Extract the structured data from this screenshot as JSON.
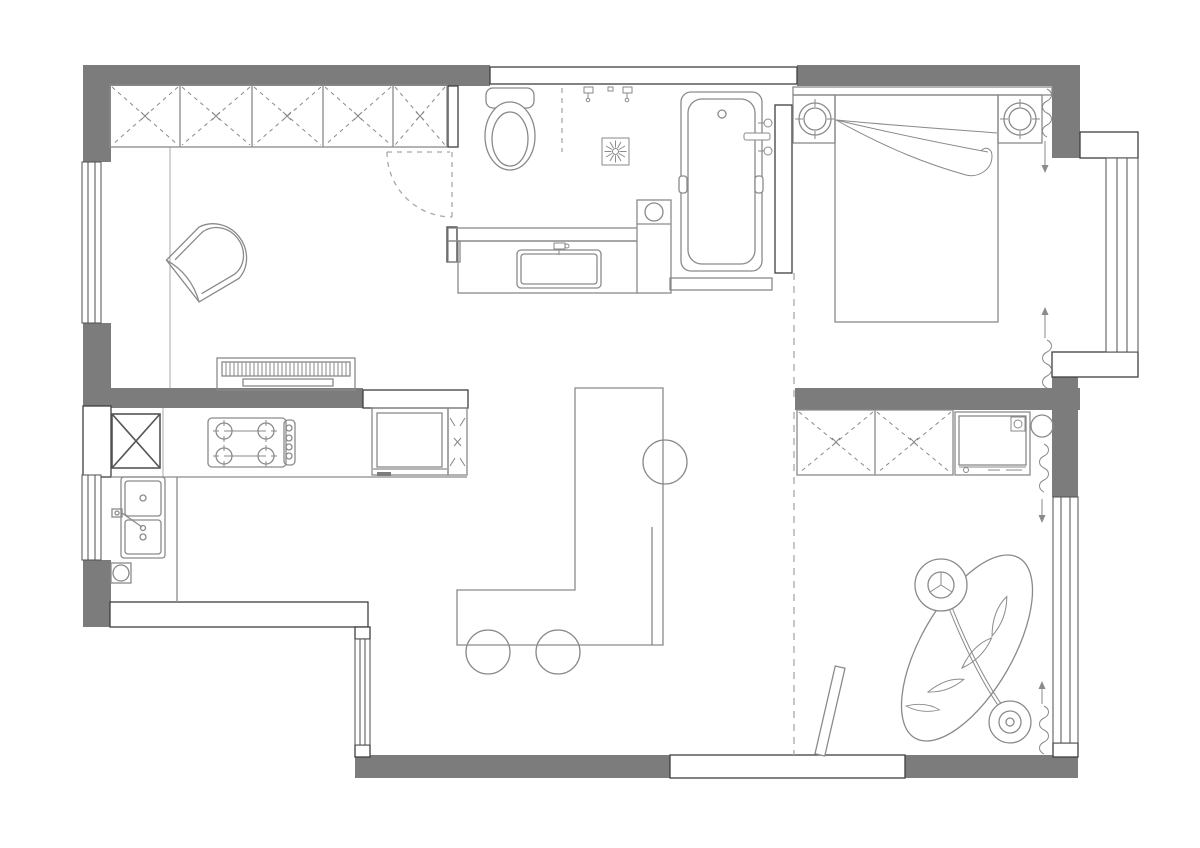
{
  "meta": {
    "kind": "architectural-floor-plan",
    "canvas_width": 1200,
    "canvas_height": 848,
    "text_labels_visible": false
  },
  "colors": {
    "background": "#ffffff",
    "wall_fill": "#7c7c7c",
    "wall_outline": "#3f3f3f",
    "window_line": "#4f4f4f",
    "furniture_line": "#8a8a8a",
    "light_line": "#aaaaaa",
    "dash_line": "#a8a8a8",
    "dark_accent": "#555555"
  },
  "rooms": [
    {
      "id": "living-room",
      "position": "top-left",
      "furniture": [
        "wardrobe",
        "armchair",
        "media-bench",
        "door-swing"
      ]
    },
    {
      "id": "kitchen",
      "position": "mid-left",
      "furniture": [
        "refrigerator",
        "gas-hob",
        "oven",
        "tall-cabinet",
        "double-sink",
        "sink-faucet",
        "floor-drain",
        "counter"
      ]
    },
    {
      "id": "dining-area",
      "position": "bottom-center",
      "furniture": [
        "l-shaped-bar-counter",
        "bar-stools"
      ]
    },
    {
      "id": "bathroom",
      "position": "top-center",
      "furniture": [
        "toilet",
        "shower-heads",
        "shower-floor-drain",
        "shower-glass-partition",
        "vanity-counter",
        "vanity-sink",
        "washer-column",
        "bathtub",
        "tub-faucet",
        "tub-platform"
      ]
    },
    {
      "id": "bedroom",
      "position": "top-right",
      "furniture": [
        "double-bed",
        "headboard",
        "nightstand-left",
        "nightstand-right",
        "lamp-left",
        "lamp-right",
        "blanket-folds",
        "curtains",
        "bay-window"
      ]
    },
    {
      "id": "second-room",
      "position": "bottom-right",
      "furniture": [
        "wardrobe",
        "washing-machine",
        "water-heater",
        "hanging-chair-with-stand",
        "leaf-plant-decor",
        "leaning-board",
        "curtains"
      ]
    }
  ],
  "counts": {
    "bar_stools": 3,
    "living_wardrobe_sections": 5,
    "second_room_wardrobe_sections": 2,
    "hob_burners": 4,
    "windows": 6,
    "wall_openings": 2,
    "curtain_runs": 4
  }
}
